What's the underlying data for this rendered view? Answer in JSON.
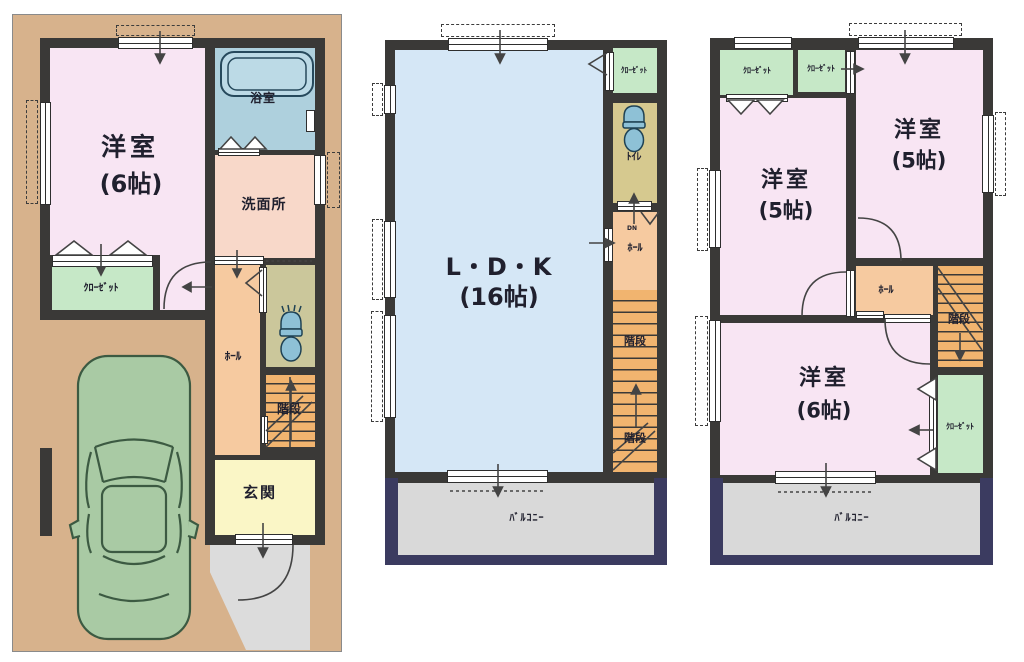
{
  "document": {
    "type": "floor-plan",
    "floors_shown": 3
  },
  "colors": {
    "wall": "#3a3937",
    "lot_tan": "#d7b28c",
    "room_pink": "#f8e5f3",
    "closet_green": "#c6e8c7",
    "bath_blue": "#aed0dd",
    "washroom_peach": "#f8d8c9",
    "toilet_khaki": "#cbc79b",
    "hall_orange": "#f6caa0",
    "stairs_orange": "#f1b46f",
    "entrance_yellow": "#faf6c6",
    "porch_gray": "#dcdcdc",
    "ldk_blue": "#d5e7f6",
    "balcony_gray": "#d9d9d9",
    "balcony_frame_navy": "#3b3b60",
    "car_green": "#a9caa4"
  },
  "floor1": {
    "rooms": {
      "western6": {
        "name": "洋室",
        "size": "(6帖)"
      },
      "bath": {
        "name": "浴室"
      },
      "washroom": {
        "name": "洗面所"
      },
      "closet": {
        "name": "ｸﾛｰｾﾞｯﾄ"
      },
      "hall": {
        "name": "ﾎｰﾙ"
      },
      "stairs": {
        "name": "階段"
      },
      "entrance": {
        "name": "玄関"
      }
    }
  },
  "floor2": {
    "rooms": {
      "ldk": {
        "name": "L・D・K",
        "size": "(16帖)"
      },
      "closet": {
        "name": "ｸﾛｰｾﾞｯﾄ"
      },
      "toilet": {
        "name": "ﾄｲﾚ"
      },
      "hall": {
        "name": "ﾎｰﾙ",
        "dn": "DN"
      },
      "stairs": {
        "name": "階段"
      },
      "balcony": {
        "name": "ﾊﾞﾙｺﾆｰ"
      }
    }
  },
  "floor3": {
    "rooms": {
      "western5a": {
        "name": "洋室",
        "size": "(5帖)"
      },
      "western5b": {
        "name": "洋室",
        "size": "(5帖)"
      },
      "western6": {
        "name": "洋室",
        "size": "(6帖)"
      },
      "closetA": {
        "name": "ｸﾛｰｾﾞｯﾄ"
      },
      "closetB": {
        "name": "ｸﾛｰｾﾞｯﾄ"
      },
      "closetC": {
        "name": "ｸﾛｰｾﾞｯﾄ"
      },
      "hall": {
        "name": "ﾎｰﾙ"
      },
      "stairs": {
        "name": "階段"
      },
      "balcony": {
        "name": "ﾊﾞﾙｺﾆｰ"
      }
    }
  }
}
